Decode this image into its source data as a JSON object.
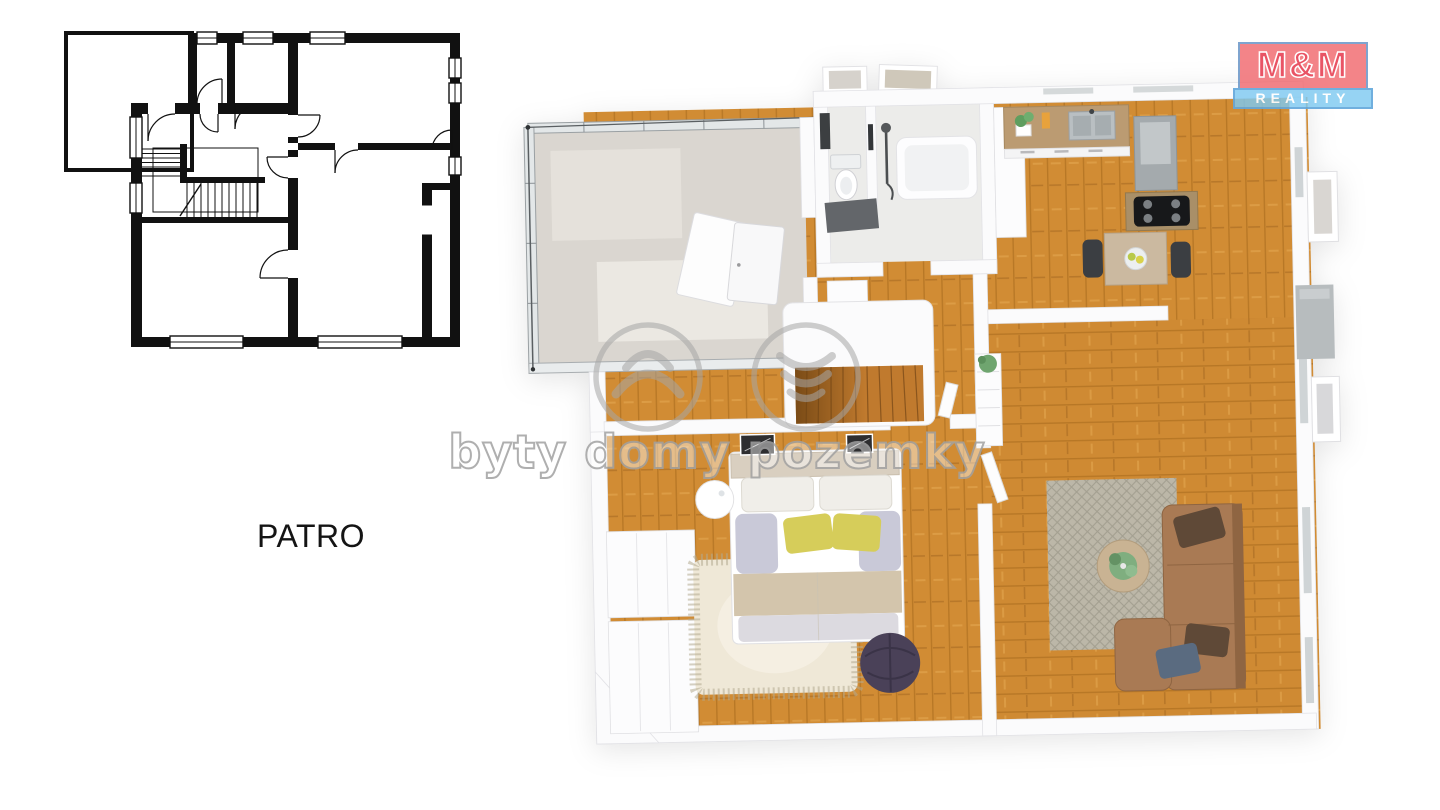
{
  "labels": {
    "floor": "PATRO"
  },
  "logo": {
    "line1": "M&M",
    "line2": "REALITY",
    "red": "#ee5a61",
    "blue": "#7ec9f1",
    "border_blue": "#5fa3d8"
  },
  "watermark": {
    "text": "byty domy pozemky",
    "color": "#a6a6a6"
  },
  "colors": {
    "page_bg": "#ffffff",
    "plan_ink": "#111111",
    "wood": "#d18c34",
    "wood_line": "#a4671c",
    "wall": "#fbfbfc",
    "wall_edge": "#e2e2e6",
    "glass": "#e3e7e8",
    "glass_frame": "#8c9296",
    "terrace_floor": "#dad6d0",
    "bath_tile": "#ececea",
    "shower_mat": "#63666a",
    "counter_wood": "#bb9b72",
    "island_wood": "#a98f68",
    "cooktop": "#17181a",
    "hood_gray": "#a4aaad",
    "sofa": "#a97a54",
    "sofa_dark": "#8f6542",
    "pillow_brown": "#5f4937",
    "pillow_blue": "#5a6b80",
    "rug_living": "#bcb7a8",
    "rug_living_motif": "#a39f90",
    "rug_bedroom": "#efe8d7",
    "pouf": "#4a4158",
    "bed_blanket": "#d3c5ac",
    "pillow_yellow": "#d6cd5a",
    "pillow_lavender": "#c9c9d8",
    "stairs_wood": "#c07a2e",
    "plant_green": "#6fa56f",
    "chimney_gray": "#b7bcbe"
  }
}
